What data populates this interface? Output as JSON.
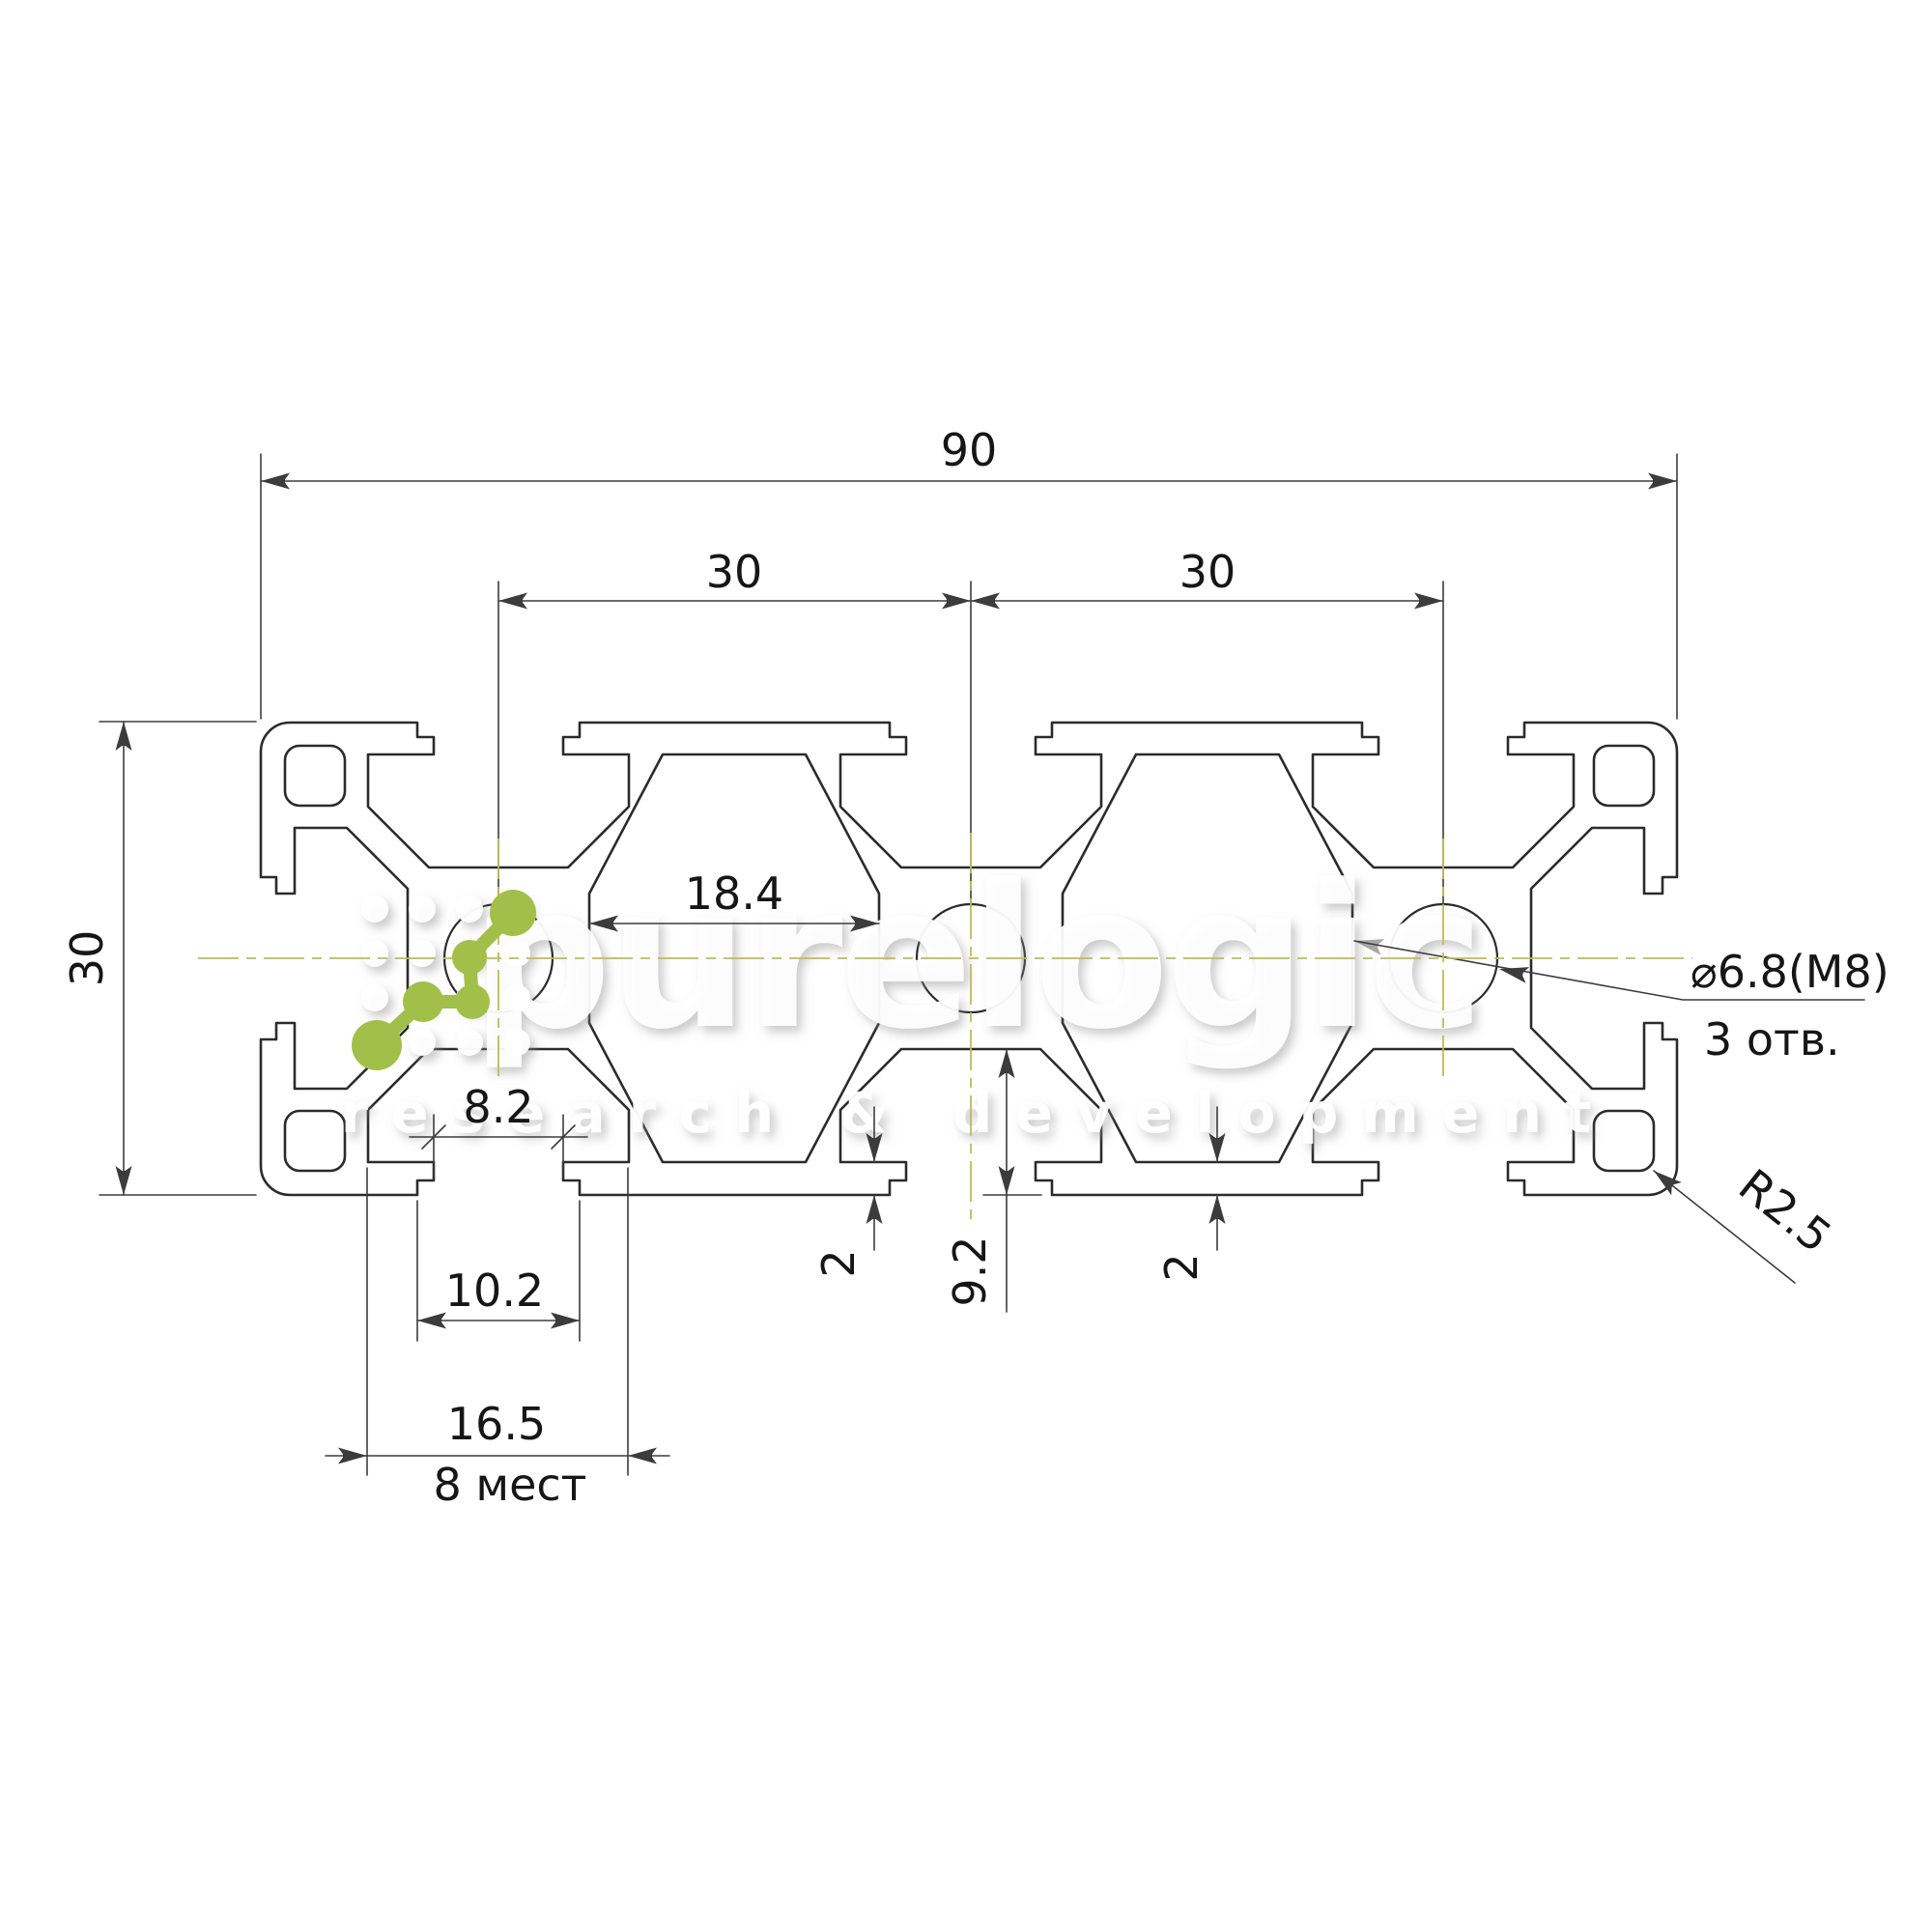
{
  "dimensions": {
    "total_width": "90",
    "pitch_left": "30",
    "pitch_right": "30",
    "height": "30",
    "cavity_width": "18.4",
    "slot_mouth_width": "8.2",
    "slot_inner_width": "10.2",
    "slot_outer_width": "16.5",
    "slot_places": "8 мест",
    "wall_thickness_left": "2",
    "wall_thickness_right": "2",
    "slot_depth": "9.2",
    "hole_callout_diameter": "⌀6.8(M8)",
    "hole_callout_count": "3 отв.",
    "corner_radius": "R2.5"
  },
  "watermark": {
    "brand": "purelogic",
    "tagline": "research & development"
  },
  "colors": {
    "line": "#2b2b2b",
    "dimension": "#3c3c3c",
    "centerline": "#b9bd5a",
    "logo_green": "#a2bf4a",
    "watermark": "#ffffff"
  }
}
